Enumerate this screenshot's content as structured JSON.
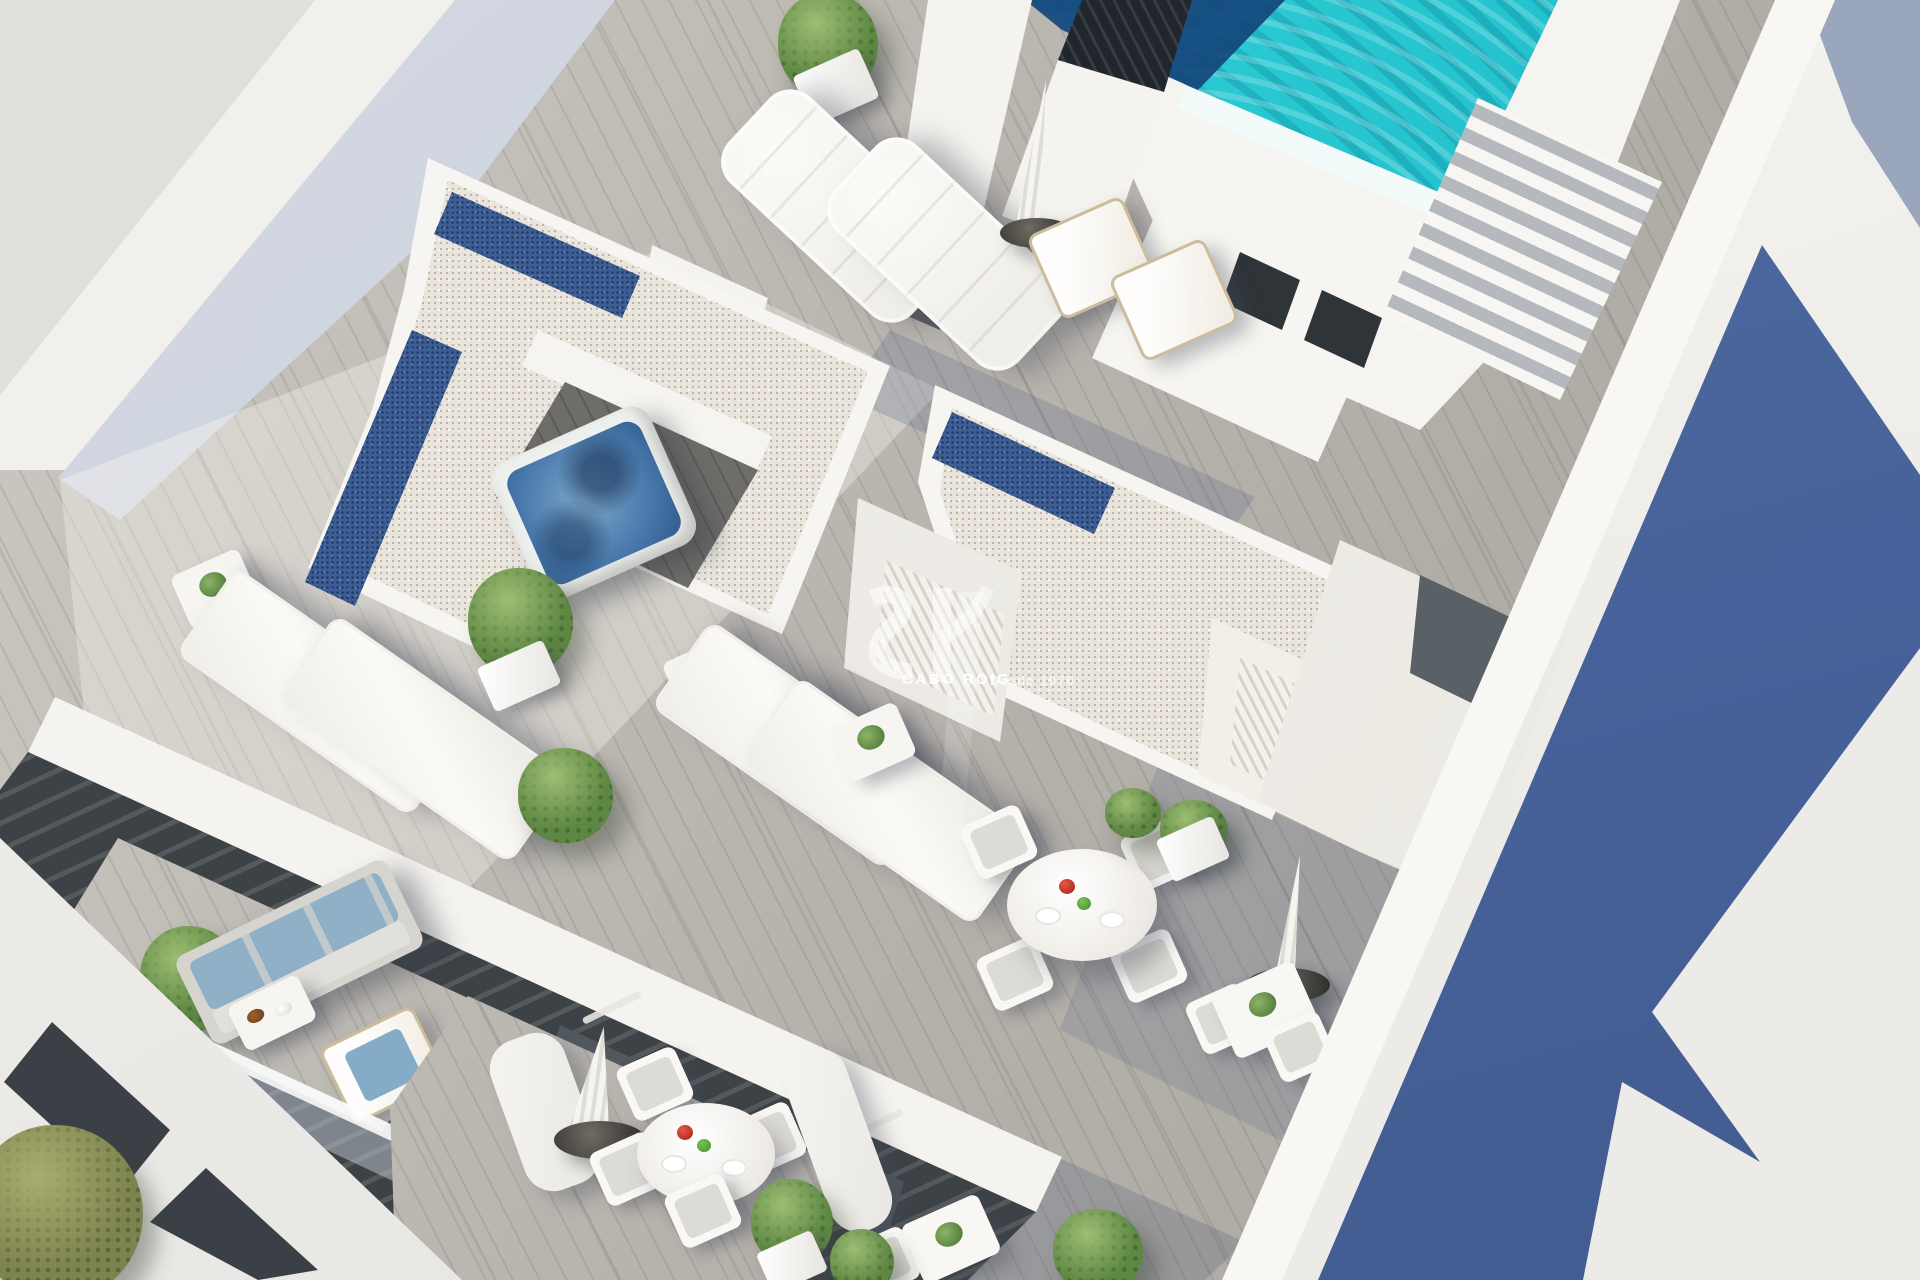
{
  "meta": {
    "type": "3d-architectural-render",
    "view": "aerial-isometric",
    "subject": "Rooftop solarium and penthouse terraces of a modern white apartment building with pool, jacuzzi and furnished balconies"
  },
  "watermark": {
    "brand": "CABO ROIG",
    "tagline": "Desde 1970",
    "logo": "cabo-roig-monogram",
    "text_color": "#ffffff"
  },
  "palette": {
    "background": "#dfddd9",
    "pool_water": "#27c6d0",
    "pool_shadow": "#15457c",
    "jacuzzi_water": "#4a7aad",
    "deck_wood": "#b9b5af",
    "deck_shade": "#8e99ad",
    "gravel": "#e9e5dd",
    "skylight_blue": "#3d5e95",
    "white_wall": "#f6f4f0",
    "wall_shade": "#c9cfdb",
    "facade_dark": "#3d4246",
    "cast_shadow_blue": "#47629a",
    "plant_green": "#6d9454",
    "cushion_blue": "#8fb0c6",
    "fruit_red": "#c4372b",
    "fruit_green": "#4a9a3a"
  },
  "scene": {
    "elements": [
      {
        "id": "swimming-pool",
        "label": "Rooftop swimming pool with rippled turquoise water"
      },
      {
        "id": "pool-stairs",
        "label": "Stairs beside the pool"
      },
      {
        "id": "ventilation-chimney",
        "label": "Black louvered ventilation chimney"
      },
      {
        "id": "jacuzzi",
        "label": "Sunken jacuzzi hot tub"
      },
      {
        "id": "gravel-roofs",
        "label": "White gravel roofs with blue skylight strips"
      },
      {
        "id": "plush-loungers",
        "label": "Two padded sun loungers"
      },
      {
        "id": "sling-loungers",
        "label": "Four white sling sun loungers"
      },
      {
        "id": "deck-chairs",
        "label": "Folding deck chairs"
      },
      {
        "id": "parasols",
        "label": "Closed parasols with round bases"
      },
      {
        "id": "round-dining-tables",
        "label": "Round white dining tables with fruit"
      },
      {
        "id": "square-tables",
        "label": "Small square side tables"
      },
      {
        "id": "balcony-sofa",
        "label": "Balcony sofa with blue cushions"
      },
      {
        "id": "planters",
        "label": "White planters with green shrubs"
      },
      {
        "id": "topiary-tree",
        "label": "Conical topiary tree"
      },
      {
        "id": "olive-tree",
        "label": "Olive tree at building corner"
      },
      {
        "id": "louvered-shutters",
        "label": "White louvered shutter doors"
      },
      {
        "id": "terrace-doors",
        "label": "Grey terrace access doors"
      },
      {
        "id": "dark-facade",
        "label": "Dark charcoal balcony facade with curtains"
      },
      {
        "id": "glass-balustrade",
        "label": "Glass balcony balustrade"
      },
      {
        "id": "neighbor-building",
        "label": "Neighbouring white building with blue cast shadow"
      }
    ]
  }
}
